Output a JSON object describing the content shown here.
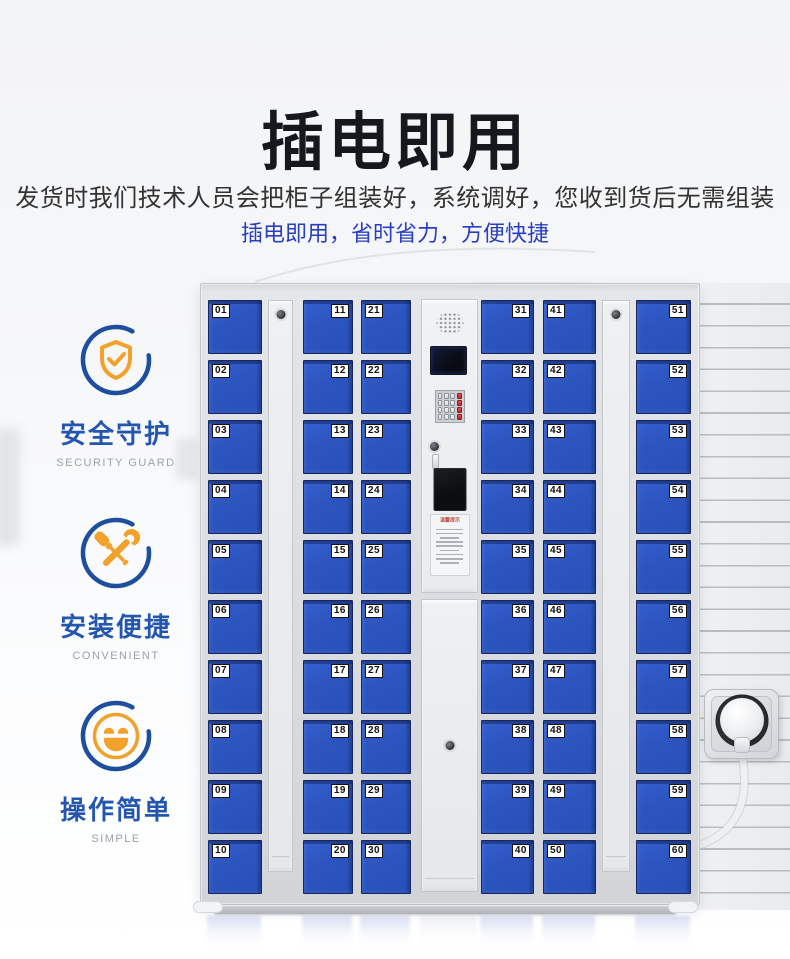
{
  "header": {
    "title": "插电即用",
    "subtitle": "发货时我们技术人员会把柜子组装好，系统调好，您收到货后无需组装",
    "tagline": "插电即用，省时省力，方便快捷"
  },
  "colors": {
    "tagline_blue": "#2a3fc0",
    "feature_label_blue": "#2456b0",
    "icon_ring_blue": "#1d4f9e",
    "icon_orange": "#f2a22a",
    "door_blue": "#2b52bc"
  },
  "features": [
    {
      "icon": "shield-check-icon",
      "zh": "安全守护",
      "en": "SECURITY GUARD"
    },
    {
      "icon": "wrench-screwdriver-icon",
      "zh": "安装便捷",
      "en": "CONVENIENT"
    },
    {
      "icon": "smiley-face-icon",
      "zh": "操作简单",
      "en": "SIMPLE"
    }
  ],
  "locker": {
    "columns": [
      {
        "type": "doors",
        "label_side": "left",
        "numbers": [
          "01",
          "02",
          "03",
          "04",
          "05",
          "06",
          "07",
          "08",
          "09",
          "10"
        ]
      },
      {
        "type": "side-panel"
      },
      {
        "type": "doors",
        "label_side": "right",
        "numbers": [
          "11",
          "12",
          "13",
          "14",
          "15",
          "16",
          "17",
          "18",
          "19",
          "20"
        ]
      },
      {
        "type": "doors",
        "label_side": "left",
        "numbers": [
          "21",
          "22",
          "23",
          "24",
          "25",
          "26",
          "27",
          "28",
          "29",
          "30"
        ]
      },
      {
        "type": "control",
        "notice_title": "温馨提示"
      },
      {
        "type": "doors",
        "label_side": "right",
        "numbers": [
          "31",
          "32",
          "33",
          "34",
          "35",
          "36",
          "37",
          "38",
          "39",
          "40"
        ]
      },
      {
        "type": "doors",
        "label_side": "left",
        "numbers": [
          "41",
          "42",
          "43",
          "44",
          "45",
          "46",
          "47",
          "48",
          "49",
          "50"
        ]
      },
      {
        "type": "side-panel"
      },
      {
        "type": "doors",
        "label_side": "right",
        "numbers": [
          "51",
          "52",
          "53",
          "54",
          "55",
          "56",
          "57",
          "58",
          "59",
          "60"
        ]
      }
    ]
  }
}
